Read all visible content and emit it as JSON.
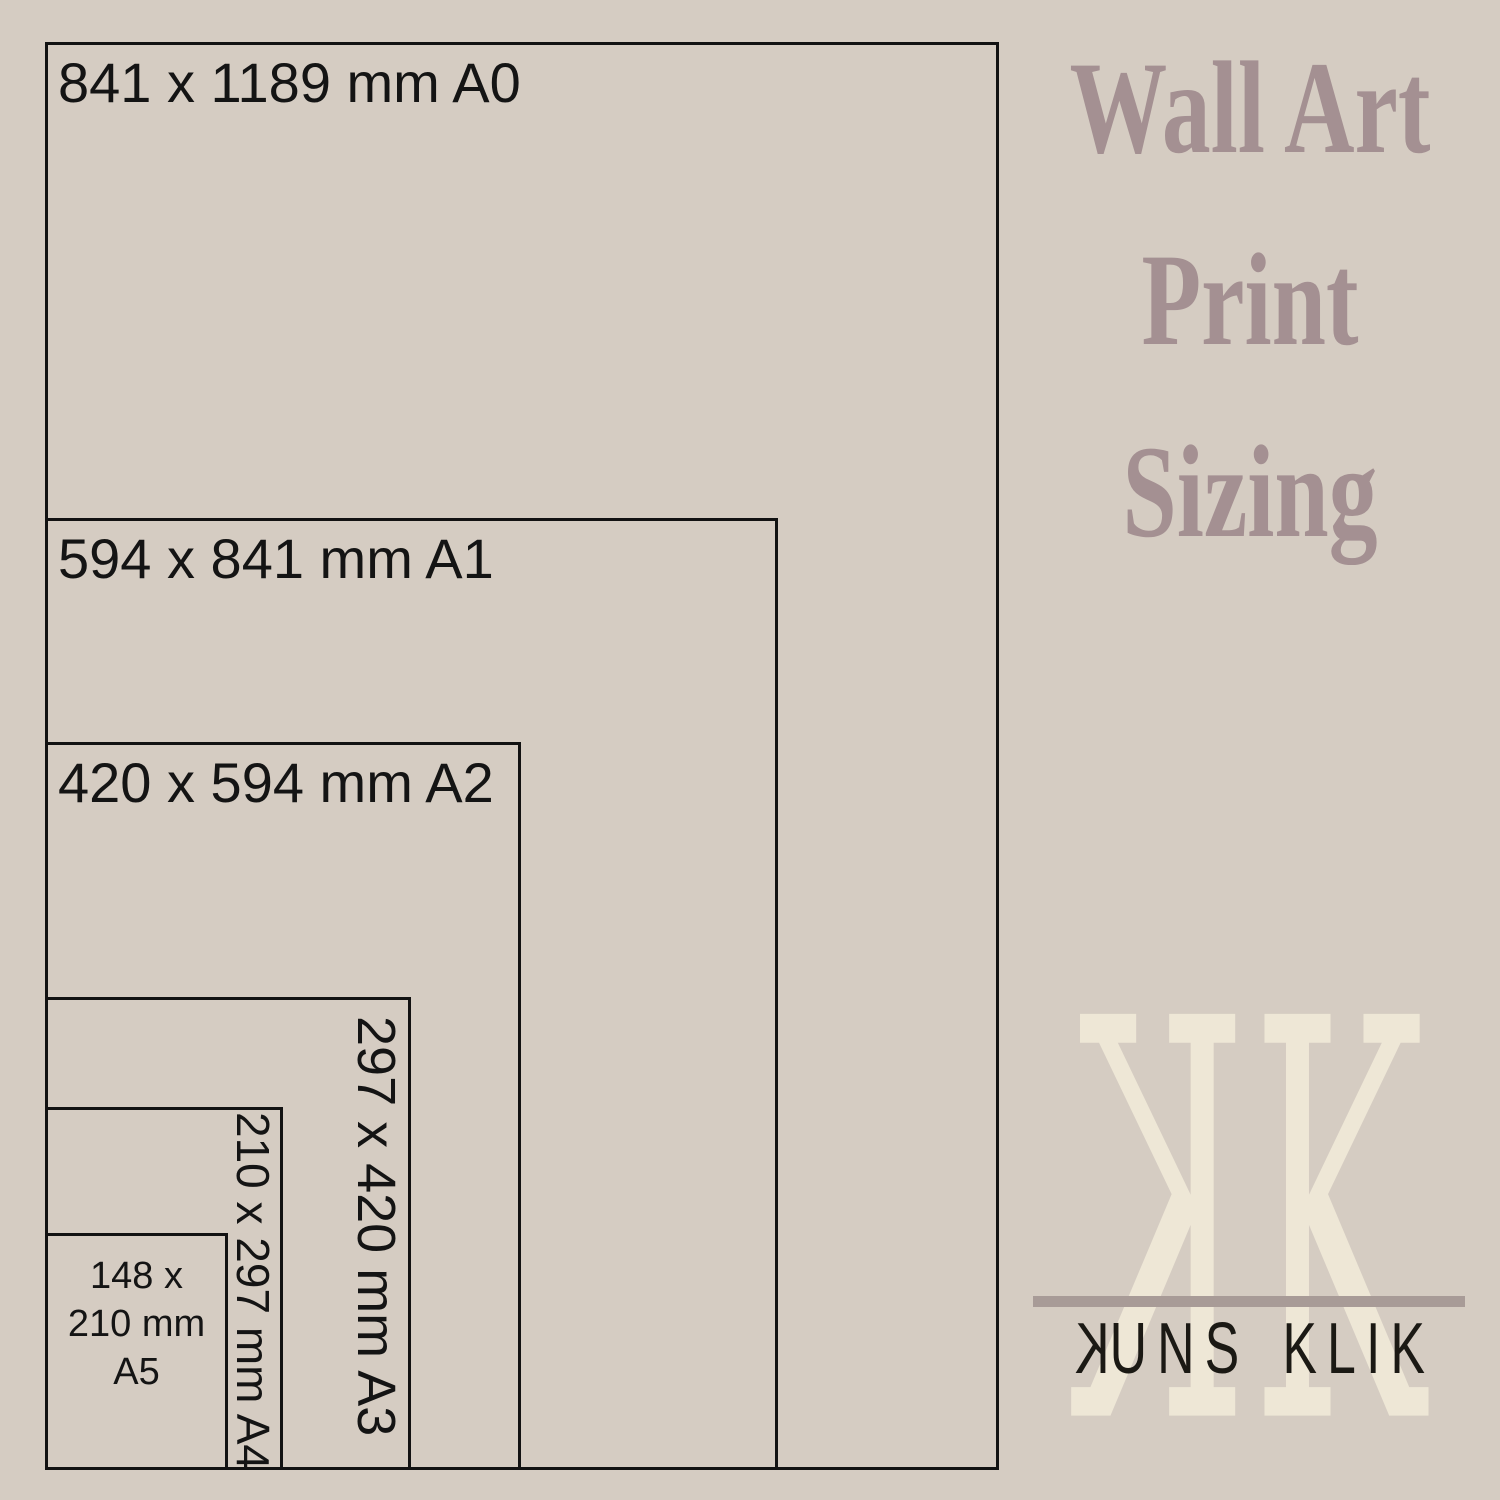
{
  "title": {
    "lines": [
      "Wall Art",
      "Print",
      "Sizing"
    ]
  },
  "diagram": {
    "sizes": [
      {
        "code": "A0",
        "label": "841 x 1189 mm A0"
      },
      {
        "code": "A1",
        "label": "594 x 841 mm A1"
      },
      {
        "code": "A2",
        "label": "420 x 594 mm A2"
      },
      {
        "code": "A3",
        "label": "297 x 420 mm A3"
      },
      {
        "code": "A4",
        "label": "210 x 297 mm A4"
      },
      {
        "code": "A5",
        "label": "148 x 210 mm A5",
        "lines": [
          "148 x",
          "210 mm",
          "A5"
        ]
      }
    ]
  },
  "logo": {
    "monogram_left": "K",
    "monogram_right": "K",
    "wordmark_first_letter": "K",
    "wordmark_left_rest": "UNS",
    "wordmark_right": "KLIK"
  },
  "colors": {
    "background": "#d5ccc2",
    "outline": "#121212",
    "label_text": "#141414",
    "title": "#a49092",
    "monogram": "#eee7d6",
    "divider": "#a89b97",
    "wordmark": "#1b1914"
  }
}
